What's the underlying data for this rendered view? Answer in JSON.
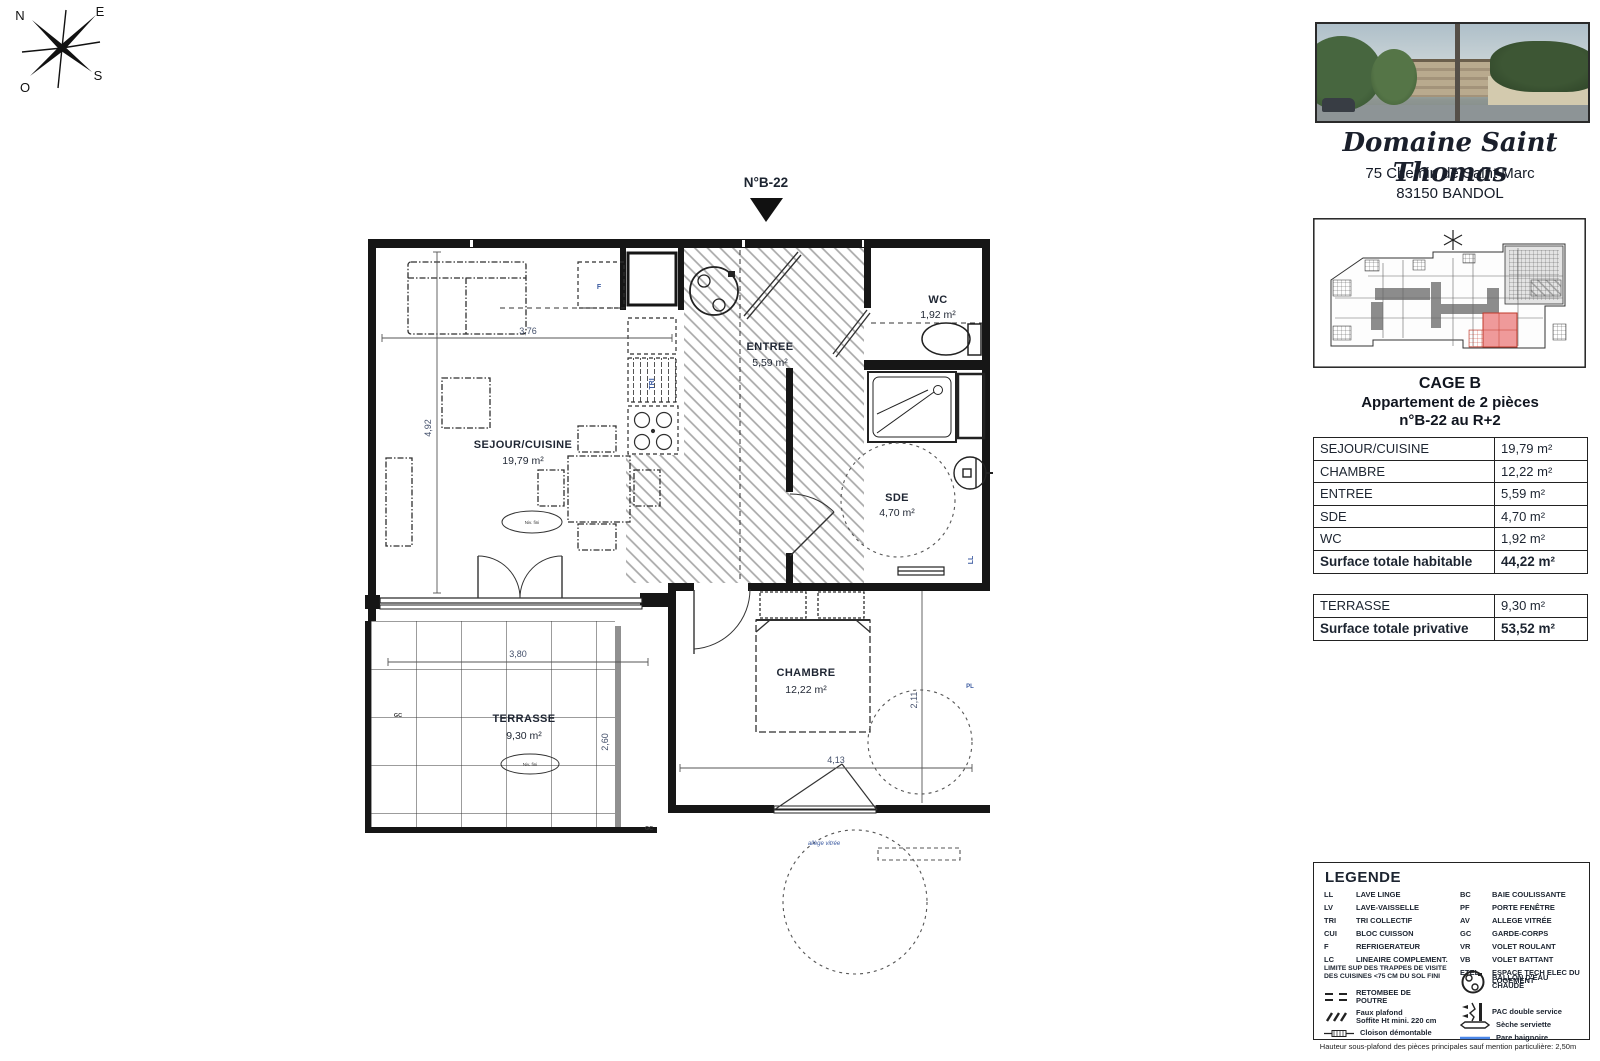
{
  "compass": {
    "n": "N",
    "e": "E",
    "s": "S",
    "o": "O"
  },
  "marker": {
    "label": "N°B-22"
  },
  "rooms": {
    "sejour": {
      "name": "SEJOUR/CUISINE",
      "area": "19,79 m²"
    },
    "chambre": {
      "name": "CHAMBRE",
      "area": "12,22 m²"
    },
    "entree": {
      "name": "ENTREE",
      "area": "5,59 m²"
    },
    "sde": {
      "name": "SDE",
      "area": "4,70 m²"
    },
    "wc": {
      "name": "WC",
      "area": "1,92 m²"
    },
    "terrasse": {
      "name": "TERRASSE",
      "area": "9,30 m²"
    }
  },
  "dims": {
    "sejour_w": "3,76",
    "sejour_h": "4,92",
    "terrasse_w": "3,80",
    "terrasse_h": "2,60",
    "chambre_w": "4,13",
    "chambre_h": "2,11"
  },
  "annotations": {
    "fridge": "F",
    "tri": "TRI",
    "lave_linge": "LL",
    "placard": "PL",
    "garde_corps_1": "GC",
    "garde_corps_2": "GC",
    "allege": "allège vitrée",
    "niv_sejour": "Niv. fini",
    "niv_terrasse": "Niv. fini"
  },
  "sidebar": {
    "title": "Domaine Saint Thomas",
    "address1": "75 Chemin de Saint Marc",
    "address2": "83150 BANDOL",
    "cage": "CAGE B",
    "type": "Appartement de 2 pièces",
    "unit": "n°B-22 au R+2",
    "table": {
      "rows": [
        {
          "label": "SEJOUR/CUISINE",
          "value": "19,79 m²"
        },
        {
          "label": "CHAMBRE",
          "value": "12,22 m²"
        },
        {
          "label": "ENTREE",
          "value": "5,59  m²"
        },
        {
          "label": "SDE",
          "value": "4,70  m²"
        },
        {
          "label": "WC",
          "value": "1,92  m²"
        }
      ],
      "total_habitable": {
        "label": "Surface totale habitable",
        "value": "44,22 m²"
      },
      "terrasse": {
        "label": "TERRASSE",
        "value": "9,30  m²"
      },
      "total_privative": {
        "label": "Surface totale privative",
        "value": "53,52 m²"
      }
    }
  },
  "legend": {
    "title": "LEGENDE",
    "left": [
      {
        "abbr": "LL",
        "label": "LAVE LINGE"
      },
      {
        "abbr": "LV",
        "label": "LAVE-VAISSELLE"
      },
      {
        "abbr": "TRI",
        "label": "TRI COLLECTIF"
      },
      {
        "abbr": "CUI",
        "label": "BLOC CUISSON"
      },
      {
        "abbr": "F",
        "label": "REFRIGERATEUR"
      },
      {
        "abbr": "LC",
        "label": "LINEAIRE COMPLEMENT."
      }
    ],
    "right": [
      {
        "abbr": "BC",
        "label": "BAIE COULISSANTE"
      },
      {
        "abbr": "PF",
        "label": "PORTE FENÊTRE"
      },
      {
        "abbr": "AV",
        "label": "ALLEGE VITRÉE"
      },
      {
        "abbr": "GC",
        "label": "GARDE-CORPS"
      },
      {
        "abbr": "VR",
        "label": "VOLET ROULANT"
      },
      {
        "abbr": "VB",
        "label": "VOLET BATTANT"
      },
      {
        "abbr": "ETEL",
        "label": "ESPACE TECH ELEC DU LOGEMENT"
      }
    ],
    "note": "LIMITE SUP DES TRAPPES DE VISITE DES CUISINES <75 CM DU SOL FINI",
    "symbols": {
      "retombee": "RETOMBEE DE POUTRE",
      "faux_plafond": "Faux plafond",
      "faux_plafond2": "Soffite Ht mini. 220 cm",
      "cloison": "Cloison démontable",
      "ballon": "BALLON D'EAU CHAUDE",
      "pac": "PAC double service",
      "seche": "Sèche serviette",
      "pare": "Pare baignoire"
    }
  },
  "footer": "Hauteur sous-plafond des pièces principales sauf mention particulière: 2,50m",
  "colors": {
    "unit_highlight": "#ef9a9a",
    "pare_baignoire": "#4a86e8"
  }
}
